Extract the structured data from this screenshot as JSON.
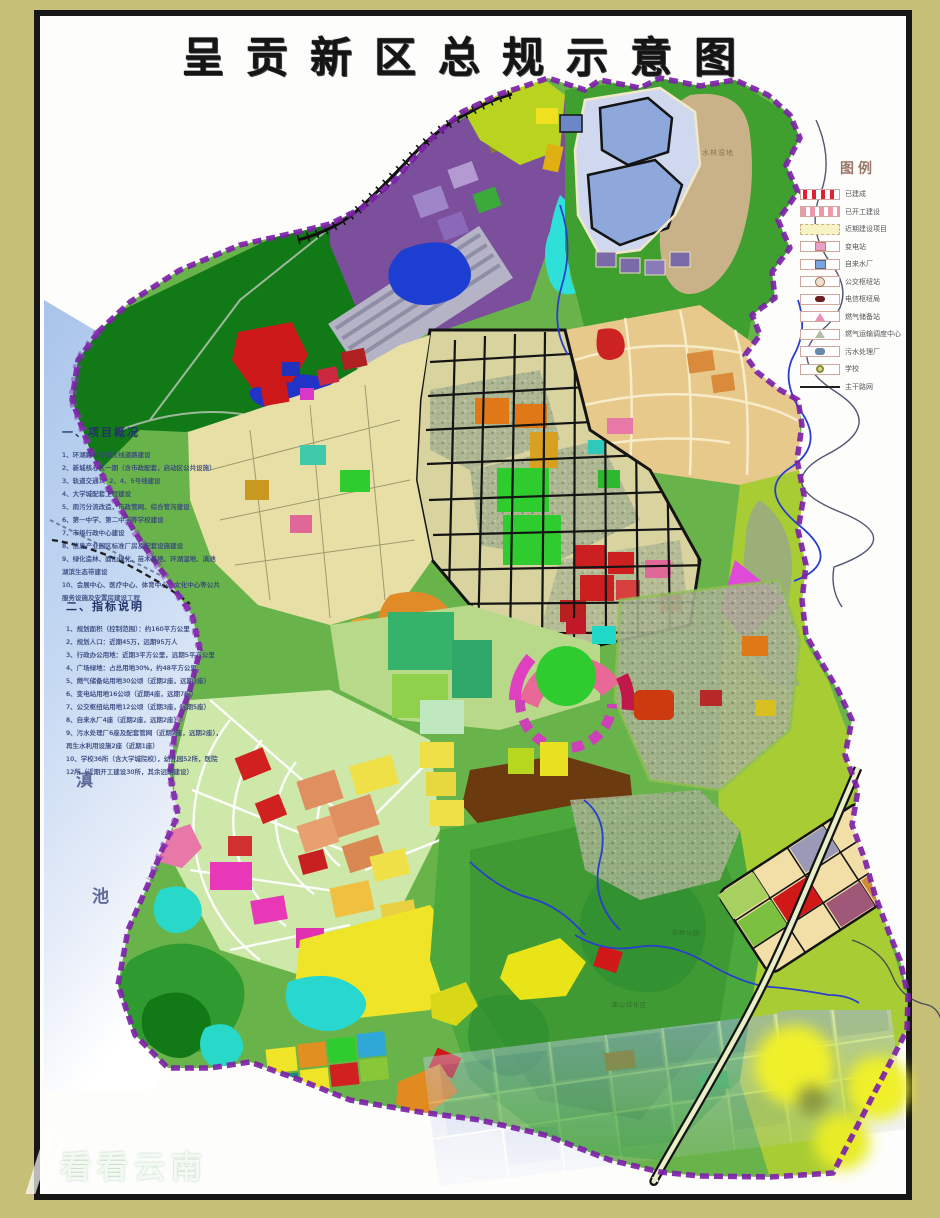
{
  "title": "呈贡新区总规示意图",
  "colors": {
    "page_margin": "#c6bf77",
    "frame": "#161616",
    "boundary_purple": "#7d22a8",
    "lake_blue": "#b9d0ee",
    "forest_green": "#117a17",
    "urban_green": "#69b44a",
    "road_black": "#141414",
    "river_blue": "#2a3fd0"
  },
  "legend": {
    "title": "图例",
    "items": [
      {
        "label": "已建成",
        "swatch": "red-text"
      },
      {
        "label": "已开工建设",
        "swatch": "pink-dash"
      },
      {
        "label": "近期建设项目",
        "swatch": "yellow-dash"
      },
      {
        "label": "变电站",
        "swatch": "pink-square"
      },
      {
        "label": "自来水厂",
        "swatch": "blue-square"
      },
      {
        "label": "公交枢纽站",
        "swatch": "circle"
      },
      {
        "label": "电信枢纽局",
        "swatch": "dark-blob"
      },
      {
        "label": "燃气储备站",
        "swatch": "pink-triangle"
      },
      {
        "label": "燃气运输调度中心",
        "swatch": "outline-triangle"
      },
      {
        "label": "污水处理厂",
        "swatch": "blue-blob"
      },
      {
        "label": "学校",
        "swatch": "olive-ring"
      },
      {
        "label": "主干路网",
        "swatch": "line"
      }
    ]
  },
  "overview": {
    "heading": "一、项目概况",
    "lines": [
      "1、环湖路和环湖东线道路建设",
      "2、新城核心区一期（含市政配套，启动区公共设施）",
      "3、轨道交通1、2、4、5号线建设",
      "4、大学城配套工程建设",
      "5、雨污分流改造，市政管网、综合管沟建设",
      "6、第一中学、第二中学等学校建设",
      "7、市级行政中心建设",
      "8、信息产业园区标准厂房及配套设施建设",
      "9、绿化造林、面山绿化、苗木基地、环湖湿地、滇池湖滨生态带建设",
      "10、会展中心、医疗中心、体育中心、文化中心等公共服务设施及安置房建设工程"
    ]
  },
  "indicators": {
    "heading": "二、指标说明",
    "lines": [
      "1、规划面积（控制范围）：约160平方公里",
      "2、规划人口：近期45万，远期95万人",
      "3、行政办公用地：近期3平方公里，远期5平方公里",
      "4、广场绿地：占总用地30%，约48平方公里",
      "5、燃气储备站用地30公顷（近期2座，远期3座）",
      "6、变电站用地16公顷（近期4座，远期7座）",
      "7、公交枢纽站用地12公顷（近期3座，远期5座）",
      "8、自来水厂4座（近期2座，远期2座）",
      "9、污水处理厂6座及配套管网（近期2座，远期2座），再生水利用设施2座（近期1座）",
      "10、学校36所（含大学城院校），幼儿园52所，医院12所（近期开工建设30所，其余远期建设）"
    ]
  },
  "lake": {
    "name": "滇池",
    "char1": "滇",
    "char2": "池"
  },
  "map_labels": {
    "northeast_area": "水林湿地",
    "south_hill": "面山绿化区",
    "south_park": "郊野公园"
  },
  "watermark": "看看云南"
}
